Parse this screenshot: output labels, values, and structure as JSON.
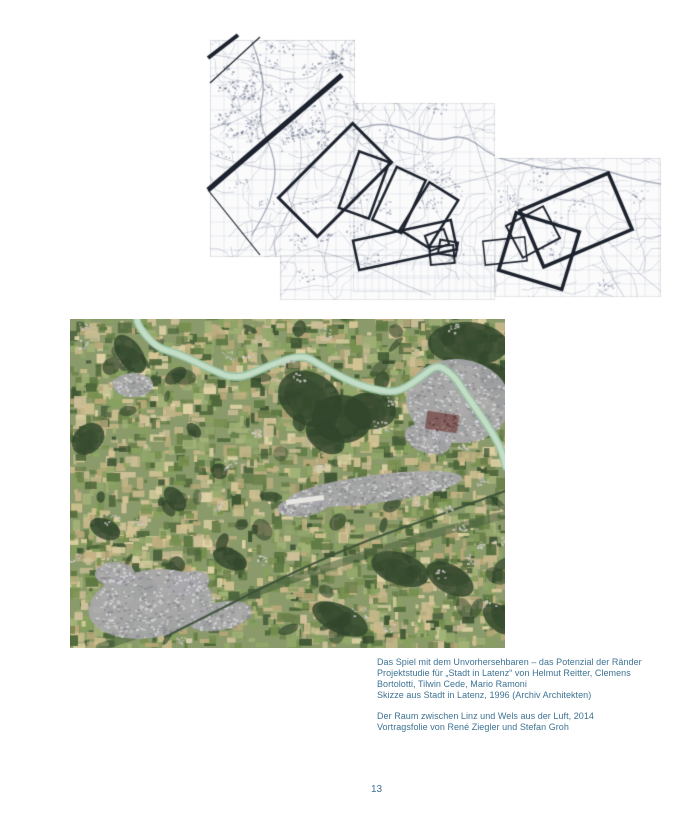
{
  "page": {
    "number": "13",
    "background": "#ffffff",
    "caption_color": "#3d7293"
  },
  "captions": {
    "block1": {
      "lines": [
        "Das Spiel mit dem Unvorhersehbaren – das Potenzial der Ränder",
        "Projektstudie für „Stadt in Latenz“ von Helmut Reitter, Clemens",
        "Bortolotti, Tilwin Cede, Mario Ramoni",
        "Skizze aus Stadt in Latenz, 1996 (Archiv Architekten)"
      ]
    },
    "block2": {
      "lines": [
        "Der Raum zwischen Linz und Wels aus der Luft, 2014",
        "Vortragsfolie von René Ziegler und Stefan Groh"
      ]
    }
  },
  "figures": {
    "map_sketch": {
      "width": 480,
      "height": 280,
      "paper": "#fbfbfc",
      "ink": "#1d232e",
      "line_color": "#5c6880",
      "grid_color": "#a9b1c4",
      "sheets": [
        [
          18,
          10,
          145,
          217
        ],
        [
          161,
          73,
          142,
          189
        ],
        [
          303,
          128,
          166,
          139
        ],
        [
          88,
          225,
          215,
          45
        ]
      ],
      "band_segments": [
        [
          [
            150,
            45
          ],
          [
            16,
            160
          ],
          5
        ],
        [
          [
            46,
            5
          ],
          [
            16,
            28
          ],
          4
        ],
        [
          [
            68,
            7
          ],
          [
            18,
            53
          ],
          1.2
        ],
        [
          [
            16,
            160
          ],
          [
            68,
            225
          ],
          1.2
        ]
      ],
      "frames": [
        [
          143,
          150,
          105,
          55,
          -45,
          3
        ],
        [
          172,
          155,
          60,
          32,
          -70,
          2.5
        ],
        [
          207,
          170,
          58,
          32,
          -65,
          2.5
        ],
        [
          237,
          185,
          56,
          34,
          -58,
          2.5
        ],
        [
          213,
          215,
          100,
          30,
          -12,
          2.5
        ],
        [
          245,
          210,
          20,
          16,
          -20,
          2
        ],
        [
          256,
          218,
          18,
          14,
          10,
          2
        ],
        [
          250,
          225,
          24,
          18,
          -5,
          2
        ],
        [
          313,
          221,
          42,
          24,
          -6,
          1.5
        ],
        [
          341,
          202,
          42,
          36,
          -28,
          2
        ],
        [
          384,
          190,
          96,
          61,
          -23,
          3.5
        ],
        [
          347,
          221,
          66,
          60,
          17,
          3.5
        ]
      ],
      "river": [
        [
          161,
          100
        ],
        [
          185,
          92
        ],
        [
          215,
          99
        ],
        [
          245,
          112
        ],
        [
          272,
          104
        ],
        [
          303,
          128
        ],
        [
          330,
          133
        ],
        [
          360,
          141
        ],
        [
          400,
          136
        ],
        [
          440,
          149
        ],
        [
          469,
          154
        ]
      ],
      "meander": [
        [
          60,
          12
        ],
        [
          75,
          50
        ],
        [
          65,
          90
        ],
        [
          85,
          130
        ],
        [
          80,
          170
        ],
        [
          60,
          205
        ]
      ]
    },
    "aerial_photo": {
      "width": 435,
      "height": 329,
      "base": "#8a9a6a",
      "field_palette": [
        "#c9b98c",
        "#d5c495",
        "#b9a87a",
        "#ded2a6",
        "#c2b184",
        "#77904f",
        "#5e7943",
        "#87a05f",
        "#4d663a",
        "#93a86b",
        "#6b7f4a",
        "#a3b378",
        "#3f5634",
        "#cfc09a"
      ],
      "forest": "#31452c",
      "river_color": "#9cc4a6",
      "river_light": "#c3ddc7",
      "river_path": [
        [
          67,
          0
        ],
        [
          67,
          6
        ],
        [
          87,
          29
        ],
        [
          107,
          34
        ],
        [
          140,
          50
        ],
        [
          167,
          61
        ],
        [
          200,
          46
        ],
        [
          233,
          35
        ],
        [
          253,
          48
        ],
        [
          283,
          64
        ],
        [
          310,
          72
        ],
        [
          330,
          73
        ],
        [
          355,
          55
        ],
        [
          368,
          45
        ],
        [
          385,
          58
        ],
        [
          393,
          71
        ],
        [
          410,
          95
        ],
        [
          430,
          126
        ],
        [
          436,
          148
        ]
      ],
      "forest_blobs": [
        [
          240,
          80,
          34,
          26
        ],
        [
          272,
          100,
          30,
          24
        ],
        [
          300,
          92,
          26,
          18
        ],
        [
          255,
          118,
          22,
          14
        ],
        [
          398,
          25,
          40,
          22
        ],
        [
          425,
          60,
          18,
          14
        ],
        [
          60,
          35,
          22,
          12
        ],
        [
          18,
          120,
          14,
          18
        ],
        [
          35,
          210,
          16,
          10
        ],
        [
          330,
          250,
          30,
          16
        ],
        [
          380,
          260,
          26,
          14
        ],
        [
          270,
          300,
          30,
          14
        ],
        [
          160,
          240,
          18,
          10
        ],
        [
          105,
          180,
          14,
          9
        ],
        [
          430,
          300,
          20,
          12
        ]
      ],
      "green_band": [
        [
          30,
          328
        ],
        [
          110,
          302
        ],
        [
          200,
          268
        ],
        [
          290,
          237
        ],
        [
          380,
          210
        ],
        [
          435,
          196
        ]
      ],
      "green_band_color": "#4a6340",
      "traun_path": [
        [
          95,
          318
        ],
        [
          160,
          285
        ],
        [
          230,
          250
        ],
        [
          300,
          220
        ],
        [
          370,
          196
        ],
        [
          435,
          172
        ]
      ],
      "traun_color": "#3c5138",
      "urban": "#a9a9ad",
      "urban_light": "#d6d6da",
      "urban_dark": "#8b8b90",
      "urban_blobs": [
        [
          80,
          285,
          62,
          34,
          -0.15
        ],
        [
          388,
          82,
          52,
          42,
          0.1
        ],
        [
          305,
          170,
          88,
          14,
          -0.13
        ],
        [
          150,
          297,
          32,
          14,
          -0.2
        ],
        [
          233,
          187,
          26,
          10,
          -0.13
        ],
        [
          45,
          255,
          20,
          12,
          0
        ],
        [
          118,
          265,
          22,
          12,
          -0.3
        ],
        [
          63,
          66,
          20,
          12,
          0
        ],
        [
          358,
          120,
          24,
          14,
          0.3
        ]
      ],
      "runway": [
        235,
        181,
        38,
        5,
        -0.13
      ],
      "runway_color": "#e8e6e0",
      "industry": [
        372,
        103,
        32,
        18,
        0.15
      ],
      "industry_color": "#7a5050"
    }
  }
}
